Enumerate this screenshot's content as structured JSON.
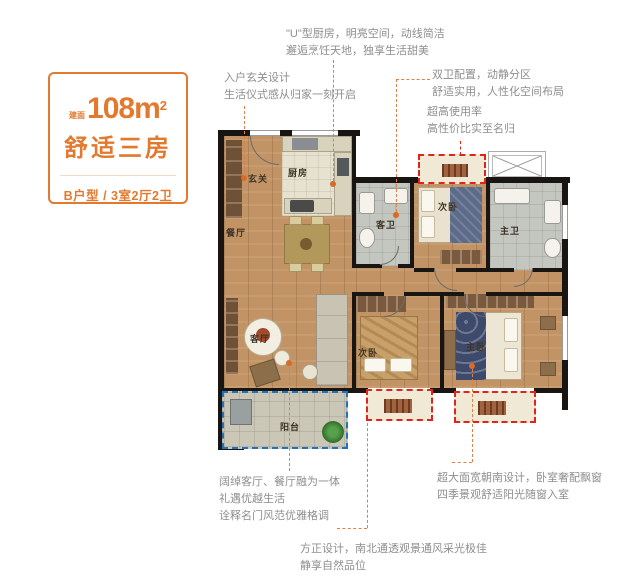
{
  "info_card": {
    "area_prefix": "建面",
    "area_value": "108m",
    "area_sup": "2",
    "subtitle": "舒适三房",
    "type_line": "B户型 / 3室2厅2卫"
  },
  "annotations": {
    "kitchen": {
      "line1": "\"U\"型厨房，明亮空间，动线简洁",
      "line2": "邂逅烹饪天地，独享生活甜美"
    },
    "entry": {
      "line1": "入户玄关设计",
      "line2": "生活仪式感从归家一刻开启"
    },
    "bathrooms": {
      "line1": "双卫配置，动静分区",
      "line2": "舒适实用，人性化空间布局"
    },
    "usage": {
      "line1": "超高使用率",
      "line2": "高性价比实至名归"
    },
    "living": {
      "line1": "阔绰客厅、餐厅融为一体",
      "line2": "礼遇优越生活",
      "line3": "诠释名门风范优雅格调"
    },
    "south": {
      "line1": "超大面宽朝南设计，卧室奢配飘窗",
      "line2": "四季景观舒适阳光随窗入室"
    },
    "square": {
      "line1": "方正设计，南北通透观景通风采光极佳",
      "line2": "静享自然品位"
    }
  },
  "rooms": {
    "entry": "玄关",
    "kitchen": "厨房",
    "dining": "餐厅",
    "guest_bath": "客卫",
    "bedroom_top": "次卧",
    "master_bath": "主卫",
    "living": "客厅",
    "bedroom_bottom": "次卧",
    "master_bedroom": "主卧",
    "balcony": "阳台"
  },
  "colors": {
    "accent_orange": "#E2792E",
    "annotation_gray": "#8E8E8E",
    "highlight_red": "#E2231A",
    "highlight_blue": "#2272B9",
    "wood_floor": "#C29465",
    "wall_black": "#181512"
  }
}
